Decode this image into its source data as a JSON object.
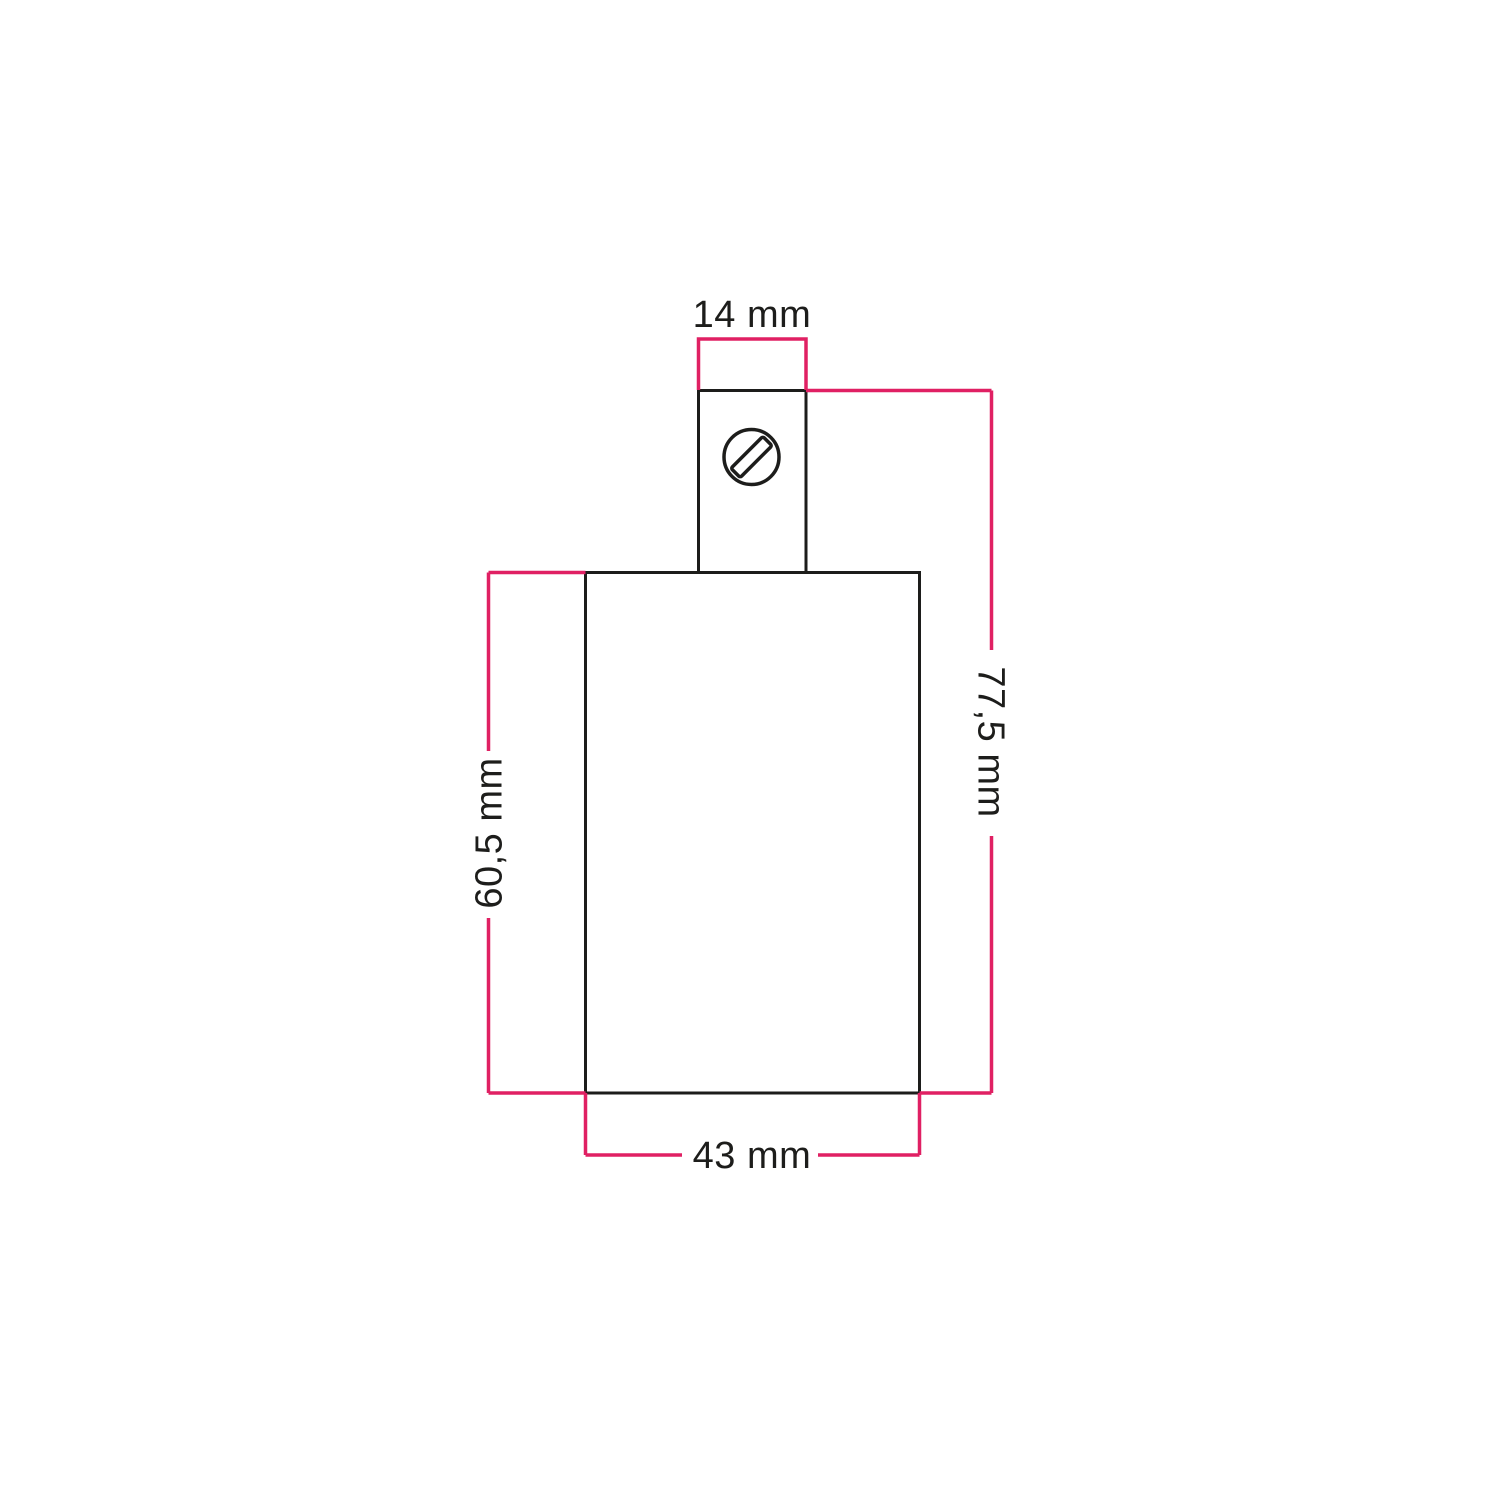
{
  "drawing": {
    "name": "socket-dimension-drawing",
    "labels": {
      "clamp_width": "14 mm",
      "total_height": "77,5 mm",
      "body_height": "60,5 mm",
      "body_width": "43 mm"
    },
    "colors": {
      "dimension_lines": "#e02063",
      "outlines": "#1d1d1b",
      "text": "#1d1d1b",
      "background": "#ffffff"
    },
    "icons": {
      "screw": "screw-head-icon"
    }
  }
}
